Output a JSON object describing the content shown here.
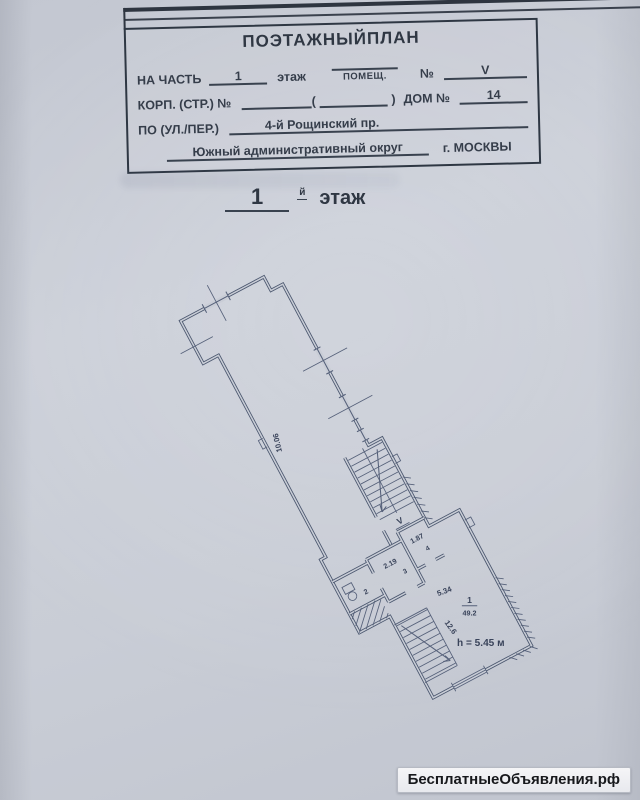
{
  "header": {
    "title": "ПОЭТАЖНЫЙПЛАН",
    "row1": {
      "label": "НА ЧАСТЬ",
      "value": "1",
      "unit": "этаж",
      "fraction_label": "ПОМЕЩ.",
      "num_label": "№",
      "num_value": "V"
    },
    "row2": {
      "label": "КОРП. (СТР.) №",
      "paren_open": "(",
      "paren_close": ")",
      "dom_label": "ДОМ №",
      "dom_value": "14"
    },
    "row3": {
      "label": "ПО (УЛ./ПЕР.)",
      "value": "4-й Рощинский пр."
    },
    "row4": {
      "okrug": "Южный административный округ",
      "city": "г. МОСКВЫ"
    }
  },
  "floor_title": {
    "number": "1",
    "suffix": "й",
    "word": "этаж"
  },
  "plan": {
    "labels": {
      "corridor_length": "10.06",
      "room3_dim": "2.19",
      "room3_num": "3",
      "room4_dim": "1.87",
      "room4_num": "4",
      "room2_num": "2",
      "main_dim": "5.34",
      "stair_dim": "12.6",
      "room1_num": "1",
      "room1_area": "49.2",
      "ceiling_height": "h = 5.45 м",
      "entry_marker": "V"
    }
  },
  "watermark": {
    "text": "БесплатныеОбъявления.рф"
  }
}
